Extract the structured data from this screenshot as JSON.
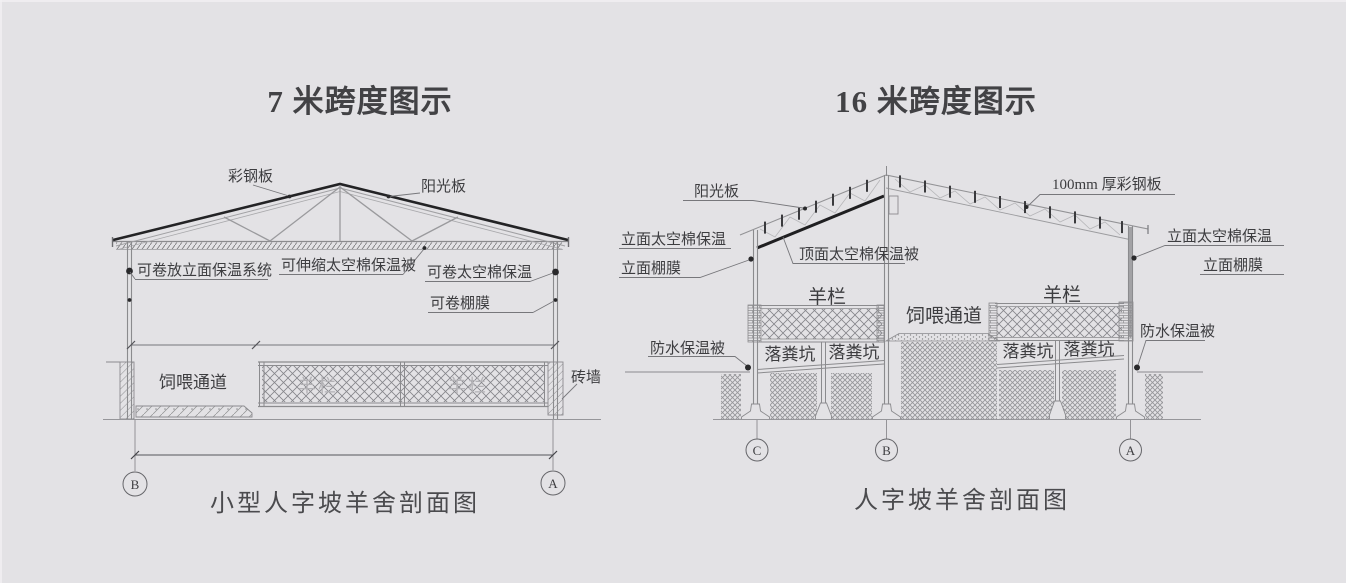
{
  "colors": {
    "background": "#e3e2e5",
    "line_gray": "#8b8b8e",
    "line_dark": "#232325",
    "text_dark": "#3d3d40",
    "faint_text": "#b3b2b6"
  },
  "left": {
    "title": "7 米跨度图示",
    "caption": "小型人字坡羊舍剖面图",
    "markers": [
      "B",
      "A"
    ],
    "labels": {
      "steel_panel": "彩钢板",
      "sun_panel": "阳光板",
      "rollable_facade_system": "可卷放立面保温系统",
      "telescopic_quilt": "可伸缩太空棉保温被",
      "rollable_cotton": "可卷太空棉保温",
      "rollable_film": "可卷棚膜",
      "feeding_passage": "饲喂通道",
      "brick_wall": "砖墙",
      "pen_watermark_1": "羊栏",
      "pen_watermark_2": "羊栏"
    }
  },
  "right": {
    "title": "16 米跨度图示",
    "caption": "人字坡羊舍剖面图",
    "markers": [
      "C",
      "B",
      "A"
    ],
    "labels": {
      "sun_panel": "阳光板",
      "steel_panel_100": "100mm 厚彩钢板",
      "top_quilt": "顶面太空棉保温被",
      "facade_cotton_left": "立面太空棉保温",
      "facade_film_left": "立面棚膜",
      "facade_cotton_right": "立面太空棉保温",
      "facade_film_right": "立面棚膜",
      "sheep_pen_left": "羊栏",
      "sheep_pen_right": "羊栏",
      "feeding_passage": "饲喂通道",
      "waterproof_left": "防水保温被",
      "waterproof_right": "防水保温被",
      "manure_pit_1": "落粪坑",
      "manure_pit_2": "落粪坑",
      "manure_pit_3": "落粪坑",
      "manure_pit_4": "落粪坑"
    }
  }
}
